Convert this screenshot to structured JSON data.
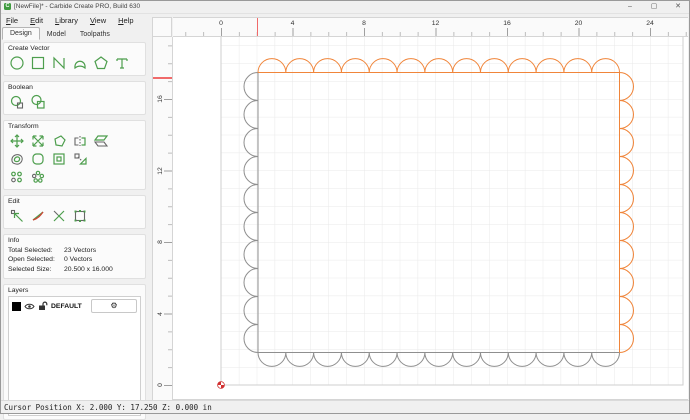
{
  "window": {
    "title": "[NewFile]* - Carbide Create PRO, Build 630",
    "app_icon": "C",
    "minimize": "–",
    "maximize": "▢",
    "close": "✕"
  },
  "menu": {
    "items": [
      {
        "label": "File"
      },
      {
        "label": "Edit"
      },
      {
        "label": "Library"
      },
      {
        "label": "View"
      },
      {
        "label": "Help"
      }
    ]
  },
  "tabs": {
    "items": [
      {
        "label": "Design",
        "active": true
      },
      {
        "label": "Model",
        "active": false
      },
      {
        "label": "Toolpaths",
        "active": false
      }
    ]
  },
  "panel": {
    "create_vector": {
      "title": "Create Vector",
      "tools": [
        "circle-tool",
        "rectangle-tool",
        "polyline-tool",
        "curve-tool",
        "polygon-tool",
        "text-tool"
      ]
    },
    "boolean": {
      "title": "Boolean",
      "tools": [
        "boolean-union-tool",
        "boolean-subtract-tool"
      ]
    },
    "transform": {
      "title": "Transform",
      "tools": [
        "move-tool",
        "scale-tool",
        "rotate-tool",
        "mirror-tool",
        "shear-tool",
        "offset-vectors-tool",
        "fillet-tool",
        "offset-path-tool",
        "scale-proportions-tool",
        "linear-array-tool",
        "circular-array-tool"
      ]
    },
    "edit": {
      "title": "Edit",
      "tools": [
        "node-edit-tool",
        "curve-edit-tool",
        "trim-vectors-tool",
        "edit-rectangle-tool"
      ]
    },
    "info": {
      "title": "Info",
      "rows": [
        {
          "label": "Total Selected:",
          "value": "23 Vectors"
        },
        {
          "label": "Open Selected:",
          "value": "0 Vectors"
        },
        {
          "label": "Selected Size:",
          "value": "20.500 x 16.000"
        }
      ]
    },
    "layers": {
      "title": "Layers",
      "items": [
        {
          "name": "DEFAULT",
          "color": "#000000"
        }
      ],
      "gear_icon": "⚙"
    }
  },
  "rulers": {
    "horizontal": {
      "labels": [
        "0",
        "4",
        "8",
        "12",
        "16",
        "20",
        "24"
      ]
    },
    "vertical": {
      "labels": [
        "16",
        "12",
        "8",
        "4",
        "0"
      ]
    },
    "cursor_marker_color": "#f06a6a"
  },
  "canvas": {
    "selection_color": "#f0853a",
    "vector_color": "#8f8f8f",
    "grid_color": "#e9e9e9",
    "drawing": {
      "selected_vectors": {
        "count": 23,
        "top_scallops": 13,
        "right_scallops": 10
      },
      "unselected_vectors": {
        "left_scallops": 10,
        "bottom_scallops": 13
      }
    }
  },
  "status": {
    "text": "Cursor Position X: 2.000 Y: 17.250 Z: 0.000 in"
  }
}
